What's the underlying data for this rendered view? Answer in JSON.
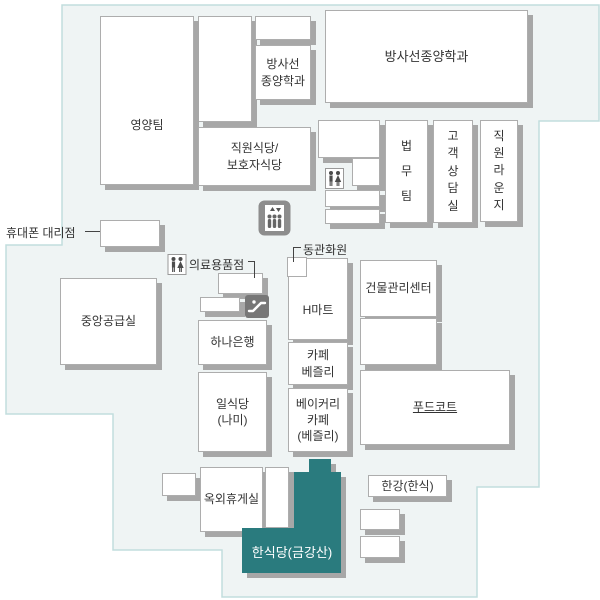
{
  "title": "병원 편의시설 층별 안내도",
  "colors": {
    "floor_fill": "#eff4f4",
    "floor_border": "#c2dddd",
    "room_border": "#adadad",
    "shadow": "#a7a7a7",
    "highlight": "#2a7b7e",
    "text": "#333333"
  },
  "rooms": {
    "nutrition_team": {
      "label": "영양팀"
    },
    "radiation_oncology_small": {
      "label": "방사선\n종양학과"
    },
    "staff_guardian_cafeteria": {
      "label": "직원식당/\n보호자식당"
    },
    "radiation_oncology_large": {
      "label": "방사선종양학과"
    },
    "legal_team": {
      "label": "법\n무\n팀"
    },
    "customer_consultation": {
      "label": "고\n객\n상\n담\n실"
    },
    "staff_lounge": {
      "label": "직\n원\n라\n운\n지"
    },
    "central_supply": {
      "label": "중앙공급실"
    },
    "hana_bank": {
      "label": "하나은행"
    },
    "hmart": {
      "label": "H마트"
    },
    "building_mgmt_center": {
      "label": "건물관리센터"
    },
    "cafe_bezley": {
      "label": "카페\n베즐리"
    },
    "bakery_cafe_bezley": {
      "label": "베이커리\n카페\n(베즐리)"
    },
    "japanese_restaurant_nami": {
      "label": "일식당\n(나미)"
    },
    "food_court": {
      "label": "푸드코트"
    },
    "outdoor_lounge": {
      "label": "옥외휴게실"
    },
    "hangang_korean": {
      "label": "한강(한식)"
    },
    "korean_restaurant_geumgangsan": {
      "label": "한식당(금강산)"
    }
  },
  "callouts": {
    "phone_store": {
      "label": "휴대폰 대리점"
    },
    "medical_supplies": {
      "label": "의료용품점"
    },
    "dongkwan_flower_shop": {
      "label": "동관화원"
    }
  },
  "icons": {
    "elevator": "elevator-icon",
    "escalator": "escalator-icon",
    "restroom_upper": "restroom-icon",
    "restroom_middle": "restroom-icon"
  }
}
